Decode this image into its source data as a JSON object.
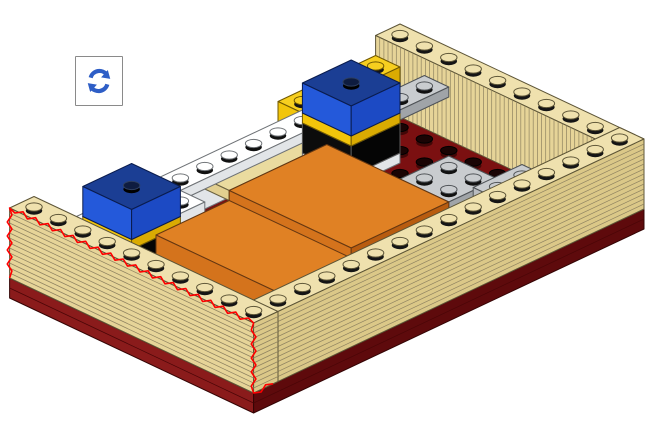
{
  "ui": {
    "rotate_button": {
      "icon": "rotate-icon",
      "accent_color": "#2E5EC6"
    }
  },
  "palette": {
    "tan": {
      "top": "#EFE1AE",
      "sw": "#E6D498",
      "se": "#DBC888",
      "outline": "#5C5436",
      "line": "#8E8260",
      "studShadow": "#151515"
    },
    "tanTile": {
      "top": "#EADB9F",
      "sw": "#E2CF90",
      "se": "#D8C582",
      "outline": "#6A6140",
      "line": "#8E8260",
      "studShadow": "#151515"
    },
    "maroon": {
      "top": "#7B1011",
      "sw": "#8A1B1B",
      "se": "#5E0A0C",
      "outline": "#330404",
      "line": "#4A0607",
      "studShadow": "#2E0404"
    },
    "white": {
      "top": "#FFFFFF",
      "sw": "#F4F5F6",
      "se": "#E2E5E8",
      "outline": "#6E7276",
      "line": "#c8c8c8",
      "studShadow": "#111111"
    },
    "gray": {
      "top": "#C9CCCF",
      "sw": "#B9BCBF",
      "se": "#A0A4A8",
      "outline": "#4F5357",
      "line": "#909396",
      "studShadow": "#111111"
    },
    "yellow": {
      "top": "#F7CF1F",
      "sw": "#F2C50B",
      "se": "#DAAB02",
      "outline": "#705800",
      "line": "#b08c00",
      "studShadow": "#151515"
    },
    "blue": {
      "top": "#1B3E94",
      "sw": "#2459DA",
      "se": "#1C4AC4",
      "outline": "#0A1C4E",
      "line": "#1c3da0",
      "studShadow": "#03081a"
    },
    "black": {
      "top": "#1B1B1B",
      "sw": "#0C0C0C",
      "se": "#050505",
      "outline": "#5A5A5A",
      "line": "#333333",
      "studShadow": "#000000"
    },
    "orange": {
      "top": "#E08124",
      "sw": "#D4731C",
      "se": "#B85C10",
      "outline": "#653711",
      "line": "#9c5410",
      "studShadow": "#151515"
    },
    "floorStud": {
      "top": "#1A0404",
      "shadow": "#420707",
      "outline": "#000000"
    },
    "blueStud": {
      "top": "#0E1C40",
      "shadow": "#000000",
      "outline": "#2E3F60"
    },
    "highlight": "#FF0000"
  },
  "scene": {
    "geometry": {
      "origin": [
        400,
        94
      ],
      "a": [
        24.4,
        11.5
      ],
      "b": [
        -24.4,
        11.5
      ],
      "plate": 10
    },
    "parts": [
      {
        "id": "baseplate-dark-red",
        "type": "slab",
        "color": "maroon",
        "i": [
          0,
          10
        ],
        "j": [
          0,
          16
        ],
        "z": [
          -2,
          0
        ],
        "stripes": "seam"
      },
      {
        "id": "floor-studs",
        "type": "studgrid",
        "stud": "floorStud",
        "i": [
          1,
          9
        ],
        "j": [
          1,
          15
        ]
      },
      {
        "id": "wall-back-right",
        "type": "box",
        "color": "tan",
        "i": [
          0,
          10
        ],
        "j": [
          0,
          1
        ],
        "z": [
          0,
          7
        ],
        "stripes": "v",
        "studs": true
      },
      {
        "id": "blue-brick-north",
        "type": "box",
        "color": "blue",
        "i": [
          0,
          1
        ],
        "j": [
          1,
          5
        ],
        "z": [
          0,
          2
        ]
      },
      {
        "id": "yellow-brick-north",
        "type": "box",
        "color": "yellow",
        "i": [
          0,
          1
        ],
        "j": [
          1,
          5
        ],
        "z": [
          2,
          5
        ],
        "studs": true
      },
      {
        "id": "gray-plate-north",
        "type": "box",
        "color": "gray",
        "i": [
          1,
          2
        ],
        "j": [
          0,
          2
        ],
        "z": [
          2,
          3
        ],
        "studs": true
      },
      {
        "id": "white-bricks-back-left",
        "type": "box",
        "color": "white",
        "i": [
          0,
          1
        ],
        "j": [
          5,
          10
        ],
        "z": [
          0,
          2
        ]
      },
      {
        "id": "tan-tile-row",
        "type": "box",
        "color": "tanTile",
        "i": [
          1,
          2
        ],
        "j": [
          5,
          9
        ],
        "z": [
          2,
          3
        ]
      },
      {
        "id": "white-plate-row",
        "type": "box",
        "color": "white",
        "i": [
          0,
          1
        ],
        "j": [
          4,
          12
        ],
        "z": [
          2,
          3
        ],
        "studs": true
      },
      {
        "id": "white-brick-left",
        "type": "box",
        "color": "white",
        "i": [
          0,
          2
        ],
        "j": [
          10,
          15
        ],
        "z": [
          0,
          3
        ],
        "studs": true
      },
      {
        "id": "gray-plate-left",
        "type": "box",
        "color": "gray",
        "i": [
          2,
          3
        ],
        "j": [
          9,
          13
        ],
        "z": [
          0,
          1
        ],
        "studs": true
      },
      {
        "id": "tower-center-white-plate",
        "type": "box",
        "color": "white",
        "i": [
          1,
          3
        ],
        "j": [
          3,
          5
        ],
        "z": [
          0,
          1
        ]
      },
      {
        "id": "tower-center-black-brick",
        "type": "box",
        "color": "black",
        "i": [
          1,
          3
        ],
        "j": [
          3,
          5
        ],
        "z": [
          1,
          4
        ]
      },
      {
        "id": "tower-center-yellow-plate",
        "type": "box",
        "color": "yellow",
        "i": [
          1,
          3
        ],
        "j": [
          3,
          5
        ],
        "z": [
          4,
          5
        ]
      },
      {
        "id": "tower-center-blue-brick",
        "type": "box",
        "color": "blue",
        "i": [
          1,
          3
        ],
        "j": [
          3,
          5
        ],
        "z": [
          5,
          8
        ],
        "studAt": [
          [
            2,
            4
          ]
        ],
        "stud": "blueStud"
      },
      {
        "id": "tower-left-white-plate",
        "type": "box",
        "color": "white",
        "i": [
          1,
          3
        ],
        "j": [
          12,
          14
        ],
        "z": [
          0,
          1
        ]
      },
      {
        "id": "tower-left-black-brick",
        "type": "box",
        "color": "black",
        "i": [
          1,
          3
        ],
        "j": [
          12,
          14
        ],
        "z": [
          1,
          4
        ]
      },
      {
        "id": "tower-left-yellow-plate",
        "type": "box",
        "color": "yellow",
        "i": [
          1,
          3
        ],
        "j": [
          12,
          14
        ],
        "z": [
          4,
          5
        ]
      },
      {
        "id": "tower-left-blue-brick",
        "type": "box",
        "color": "blue",
        "i": [
          1,
          3
        ],
        "j": [
          12,
          14
        ],
        "z": [
          5,
          8
        ],
        "studAt": [
          [
            2,
            13
          ]
        ],
        "stud": "blueStud"
      },
      {
        "id": "gray-brick-mid",
        "type": "box",
        "color": "gray",
        "i": [
          5,
          7
        ],
        "j": [
          3,
          5
        ],
        "z": [
          0,
          3
        ],
        "studs": true
      },
      {
        "id": "gray-plate-right",
        "type": "box",
        "color": "gray",
        "i": [
          6,
          8
        ],
        "j": [
          1,
          3
        ],
        "z": [
          0,
          1
        ],
        "studs": true
      },
      {
        "id": "orange-tile-upper",
        "type": "box",
        "color": "orange",
        "i": [
          2,
          7
        ],
        "j": [
          5,
          9
        ],
        "z": [
          1,
          3
        ]
      },
      {
        "id": "orange-tile-lower",
        "type": "box",
        "color": "orange",
        "i": [
          2,
          7
        ],
        "j": [
          9,
          12
        ],
        "z": [
          0,
          2
        ]
      },
      {
        "id": "wall-front-right",
        "type": "box",
        "color": "tan",
        "i": [
          9,
          10
        ],
        "j": [
          0,
          16
        ],
        "z": [
          0,
          7
        ],
        "stripes": "h",
        "studs": true
      },
      {
        "id": "wall-front-left-new-piece",
        "type": "box",
        "color": "tan",
        "i": [
          0,
          10
        ],
        "j": [
          15,
          16
        ],
        "z": [
          0,
          7
        ],
        "stripes": "h",
        "studs": true
      },
      {
        "id": "new-piece-red-outline",
        "type": "outline",
        "path": [
          [
            0,
            16,
            0
          ],
          [
            0,
            16,
            7
          ],
          [
            10,
            16,
            7
          ],
          [
            10,
            16,
            0
          ],
          [
            10,
            15.2,
            0
          ]
        ]
      }
    ]
  }
}
